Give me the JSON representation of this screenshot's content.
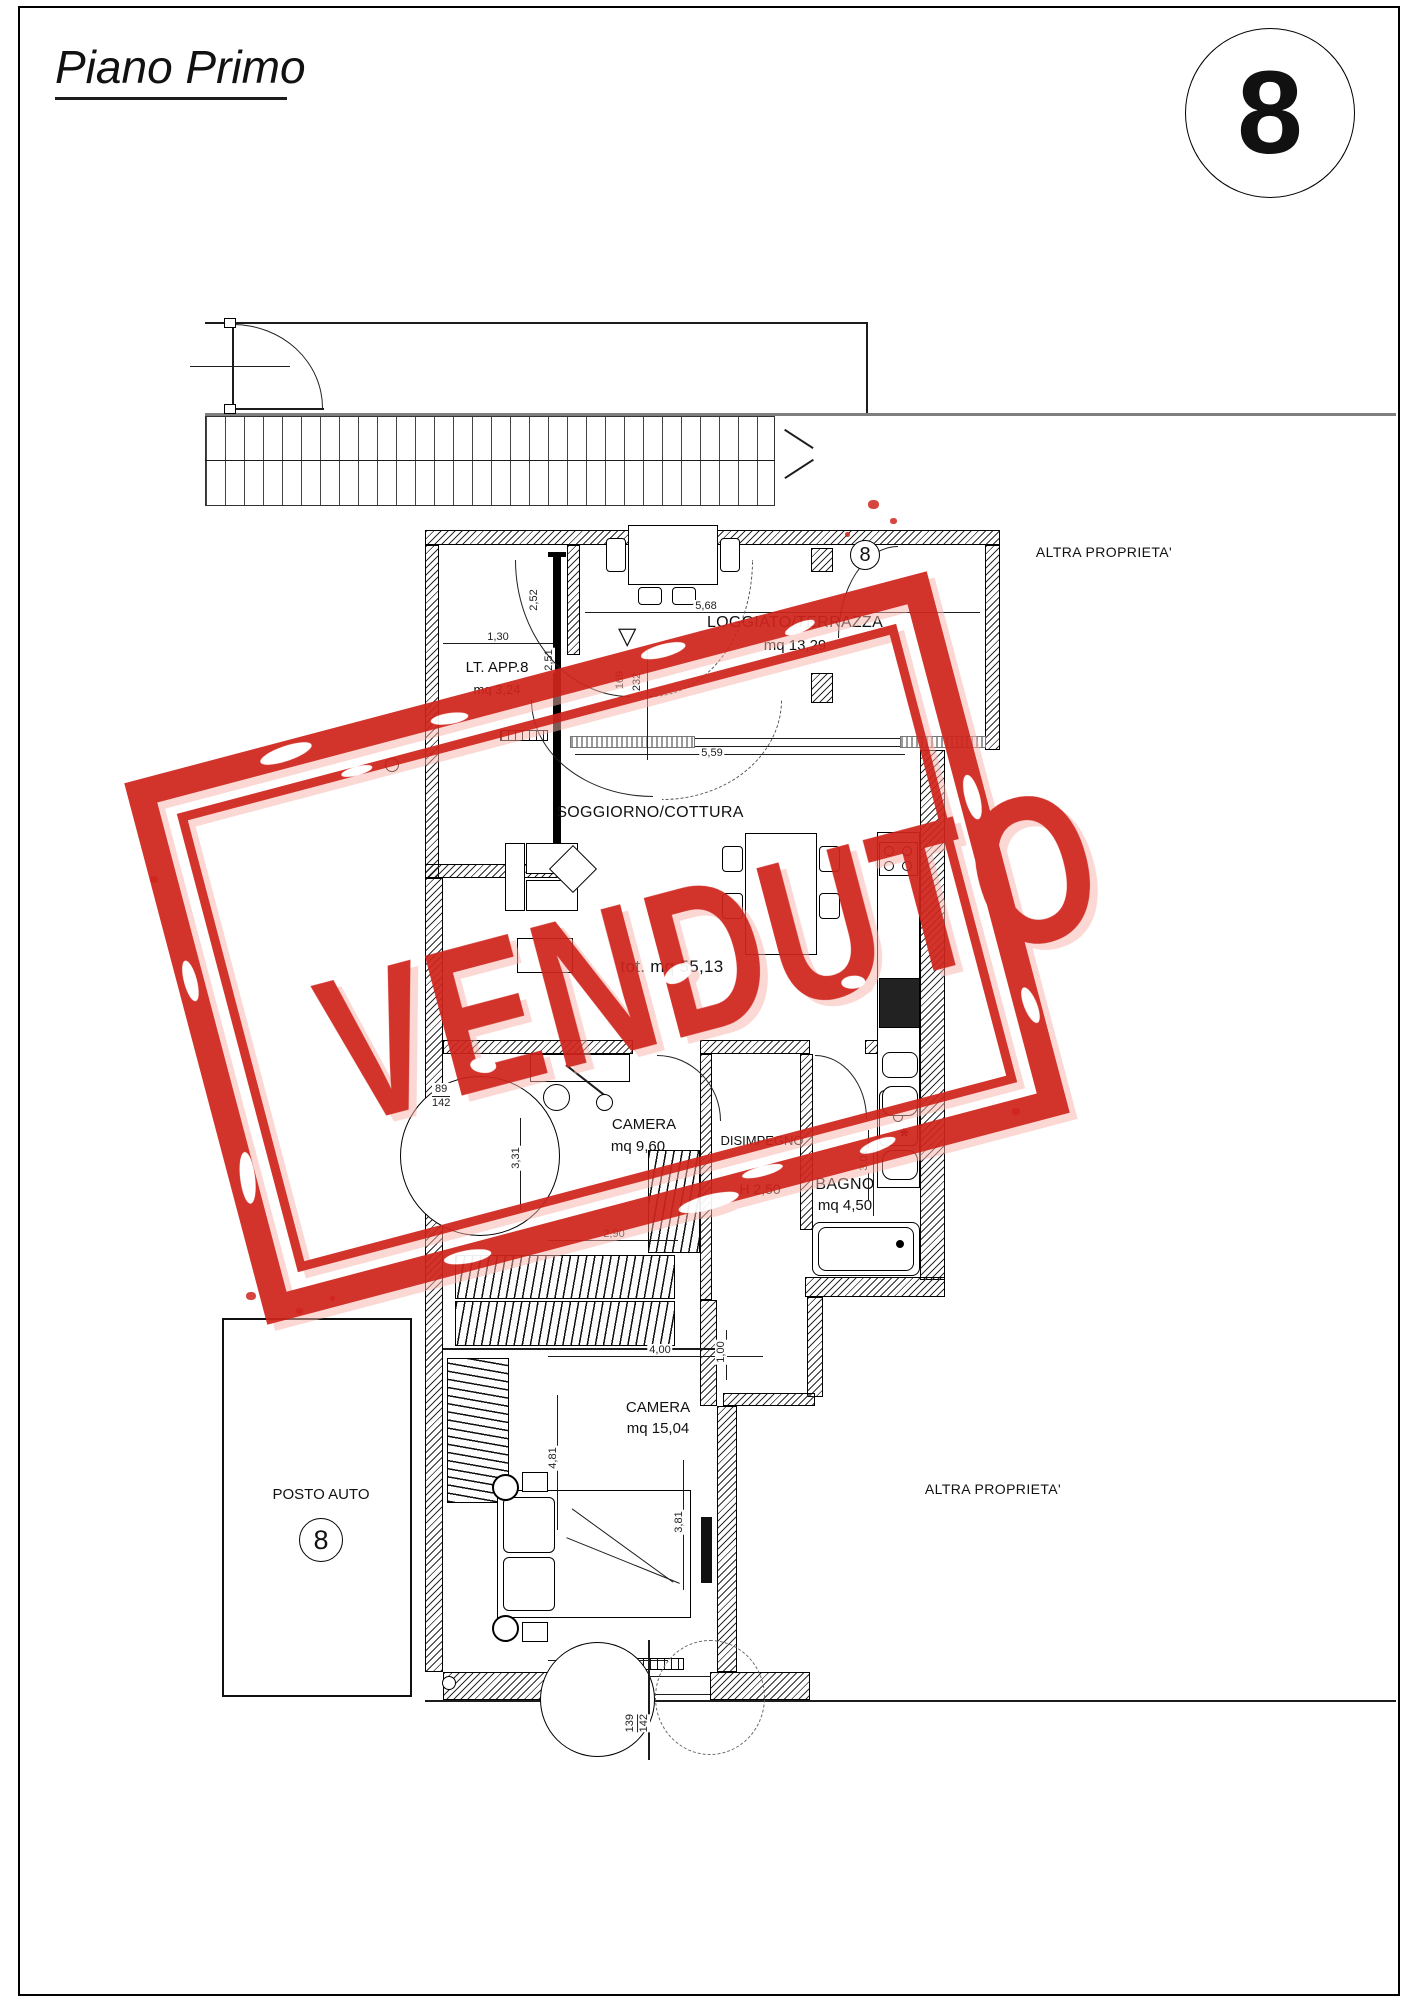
{
  "page": {
    "title": "Piano Primo",
    "unit_badge": "8"
  },
  "stamp": {
    "text": "VENDUTO",
    "color": "#cf241c"
  },
  "boundaries": {
    "altra_proprieta_top": "ALTRA PROPRIETA'",
    "altra_proprieta_bottom": "ALTRA PROPRIETA'"
  },
  "parking": {
    "label": "POSTO AUTO",
    "number": "8"
  },
  "total_area": "tot. mq 55,13",
  "rooms": {
    "lt_app": {
      "name": "LT. APP.8",
      "area": "mq 3,24"
    },
    "loggiato": {
      "name": "LOGGIATO/TERRAZZA",
      "area": "mq 13,29",
      "badge": "8"
    },
    "soggiorno": {
      "name": "SOGGIORNO/COTTURA"
    },
    "camera1": {
      "name": "CAMERA",
      "area": "mq 9,60"
    },
    "disimpegno": {
      "name": "DISIMPEGNO",
      "height": "H 2,50"
    },
    "bagno": {
      "name": "BAGNO",
      "area": "mq 4,50"
    },
    "camera2": {
      "name": "CAMERA",
      "area": "mq 15,04"
    }
  },
  "dimensions": {
    "d130": "1,30",
    "d251": "2,51",
    "d252": "2,52",
    "d568": "5,68",
    "d169": "169",
    "d232": "232",
    "d559": "5,59",
    "d290a": "2,90",
    "d331": "3,31",
    "d89": "89",
    "d142a": "142",
    "d301": "3,01",
    "d100": "1,00",
    "d400": "4,00",
    "d481": "4,81",
    "d381": "3,81",
    "d290b": "2,90",
    "d139": "139",
    "d142b": "142",
    "triangle": "▽"
  }
}
